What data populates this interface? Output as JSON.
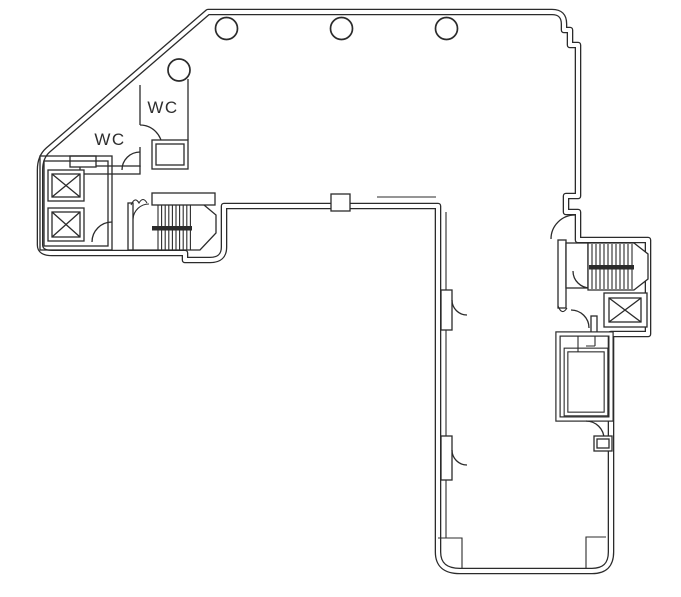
{
  "plan": {
    "background": "#ffffff",
    "line_color": "#2b2b2b",
    "labels": {
      "wc_upper": "WC",
      "wc_lower": "WC"
    }
  }
}
